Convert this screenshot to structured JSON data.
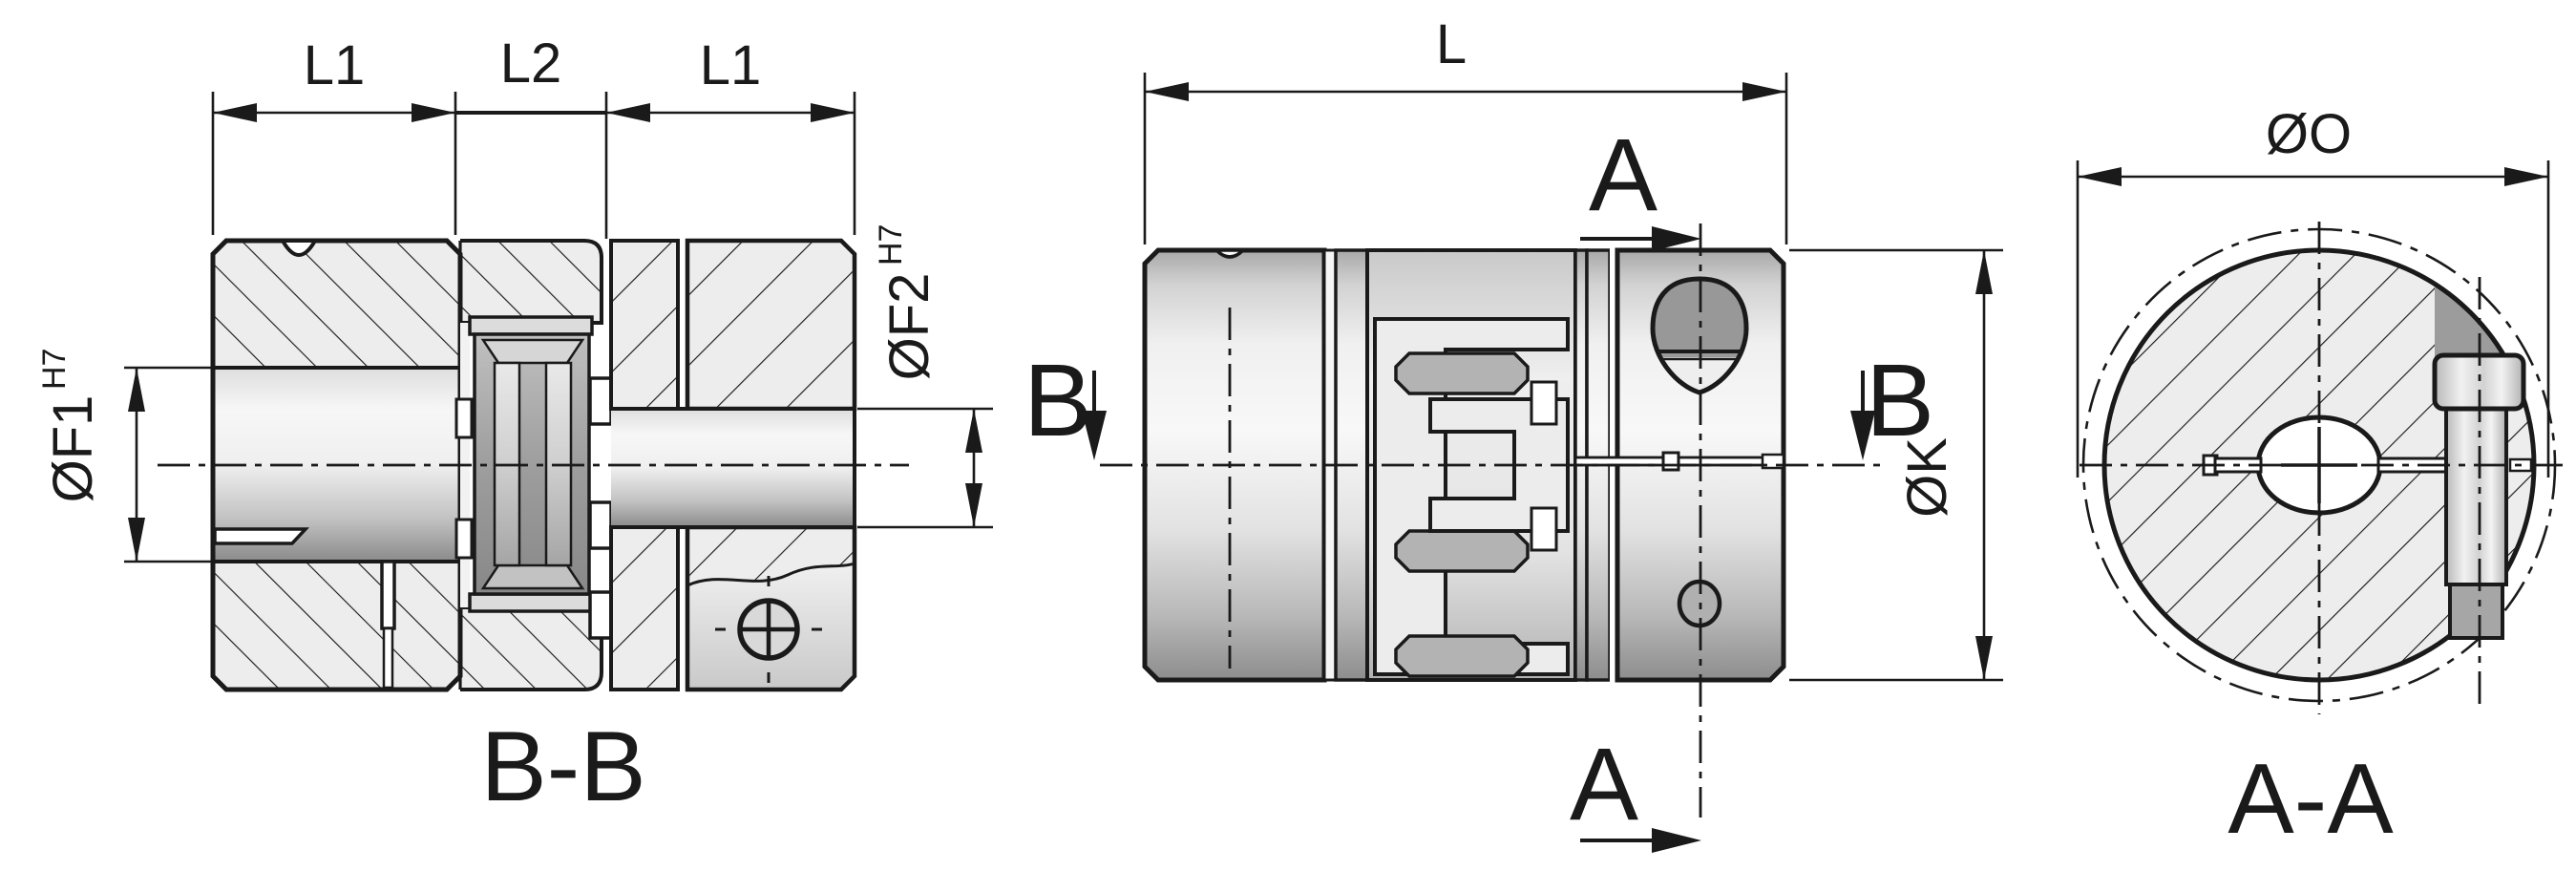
{
  "drawing_type": "coupling-technical-drawing",
  "palette": {
    "paper": "#ffffff",
    "line": "#1a1a1a",
    "section_fill": "#ededed",
    "elastomer": "#9e9e9e",
    "hole_dark": "#989898"
  },
  "views": {
    "section_bb": {
      "caption": "B-B",
      "dim_l1_left": "L1",
      "dim_l2": "L2",
      "dim_l1_right": "L1",
      "dia_f1": "ØF1",
      "dia_f1_tol": "H7",
      "dia_f2": "ØF2",
      "dia_f2_tol": "H7"
    },
    "side": {
      "dim_l": "L",
      "dia_k": "ØK",
      "section_a_top": "A",
      "section_a_bottom": "A",
      "section_b_left": "B",
      "section_b_right": "B"
    },
    "section_aa": {
      "caption": "A-A",
      "dia_o": "ØO"
    }
  }
}
